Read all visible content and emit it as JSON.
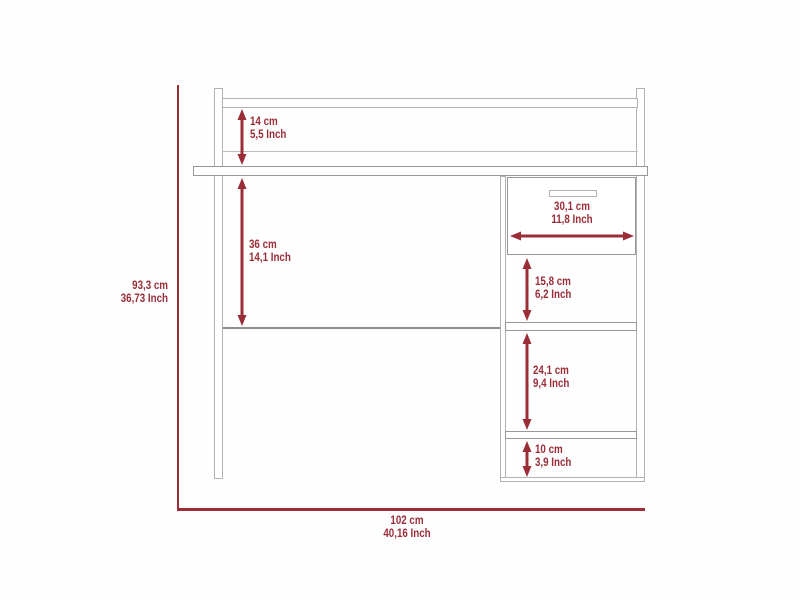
{
  "diagram": {
    "type": "furniture-dimension-drawing",
    "subject": "desk with hutch shelf and side drawer cabinet"
  },
  "dimensions": {
    "overall_height": {
      "cm": "93,3 cm",
      "inch": "36,73 Inch"
    },
    "overall_width": {
      "cm": "102 cm",
      "inch": "40,16 Inch"
    },
    "hutch_clearance": {
      "cm": "14 cm",
      "inch": "5,5 Inch"
    },
    "desk_clearance": {
      "cm": "36 cm",
      "inch": "14,1 Inch"
    },
    "drawer_width": {
      "cm": "30,1 cm",
      "inch": "11,8 Inch"
    },
    "upper_compartment_height": {
      "cm": "15,8 cm",
      "inch": "6,2 Inch"
    },
    "middle_compartment_height": {
      "cm": "24,1 cm",
      "inch": "9,4 Inch"
    },
    "lower_compartment_height": {
      "cm": "10 cm",
      "inch": "3,9 Inch"
    }
  },
  "colors": {
    "dimension": "#9a2d38",
    "structure": "#b2b2b2",
    "background": "#fefefe"
  }
}
